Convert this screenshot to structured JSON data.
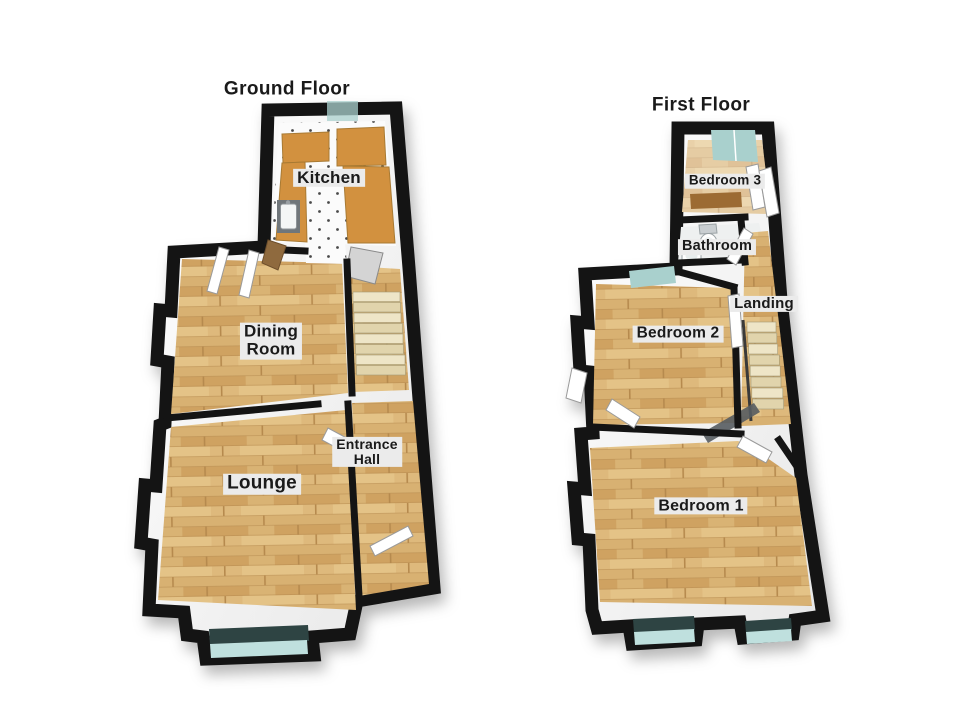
{
  "page_bg": "#ffffff",
  "colors": {
    "wall": "#141414",
    "wood": "#d8b172",
    "wood_mid": "#cfa261",
    "wood_light": "#e4c387",
    "wood_joint": "#b68a4e",
    "tile": "#fbfbfb",
    "tile_dot": "#4a4a4a",
    "counter": "#d2913f",
    "counter_edge": "#a87a33",
    "stair": "#eee5c7",
    "stair_alt": "#e1d4ac",
    "window": "#a9d0cd",
    "window_dark": "#2e4443",
    "window_glow": "#bfe0de",
    "bath_floor": "#eef0f0",
    "label_bg": "#ebebeb",
    "text": "#1a1a1a",
    "page_bg": "#ffffff"
  },
  "ground_floor": {
    "title": "Ground Floor",
    "rooms": {
      "kitchen": {
        "label": "Kitchen"
      },
      "dining_room": {
        "lines": [
          "Dining",
          "Room"
        ]
      },
      "entrance_hall": {
        "lines": [
          "Entrance",
          "Hall"
        ]
      },
      "lounge": {
        "label": "Lounge"
      }
    }
  },
  "first_floor": {
    "title": "First Floor",
    "rooms": {
      "bedroom_3": {
        "label": "Bedroom 3"
      },
      "bathroom": {
        "label": "Bathroom"
      },
      "landing": {
        "label": "Landing"
      },
      "bedroom_2": {
        "label": "Bedroom 2"
      },
      "bedroom_1": {
        "label": "Bedroom 1"
      }
    }
  }
}
